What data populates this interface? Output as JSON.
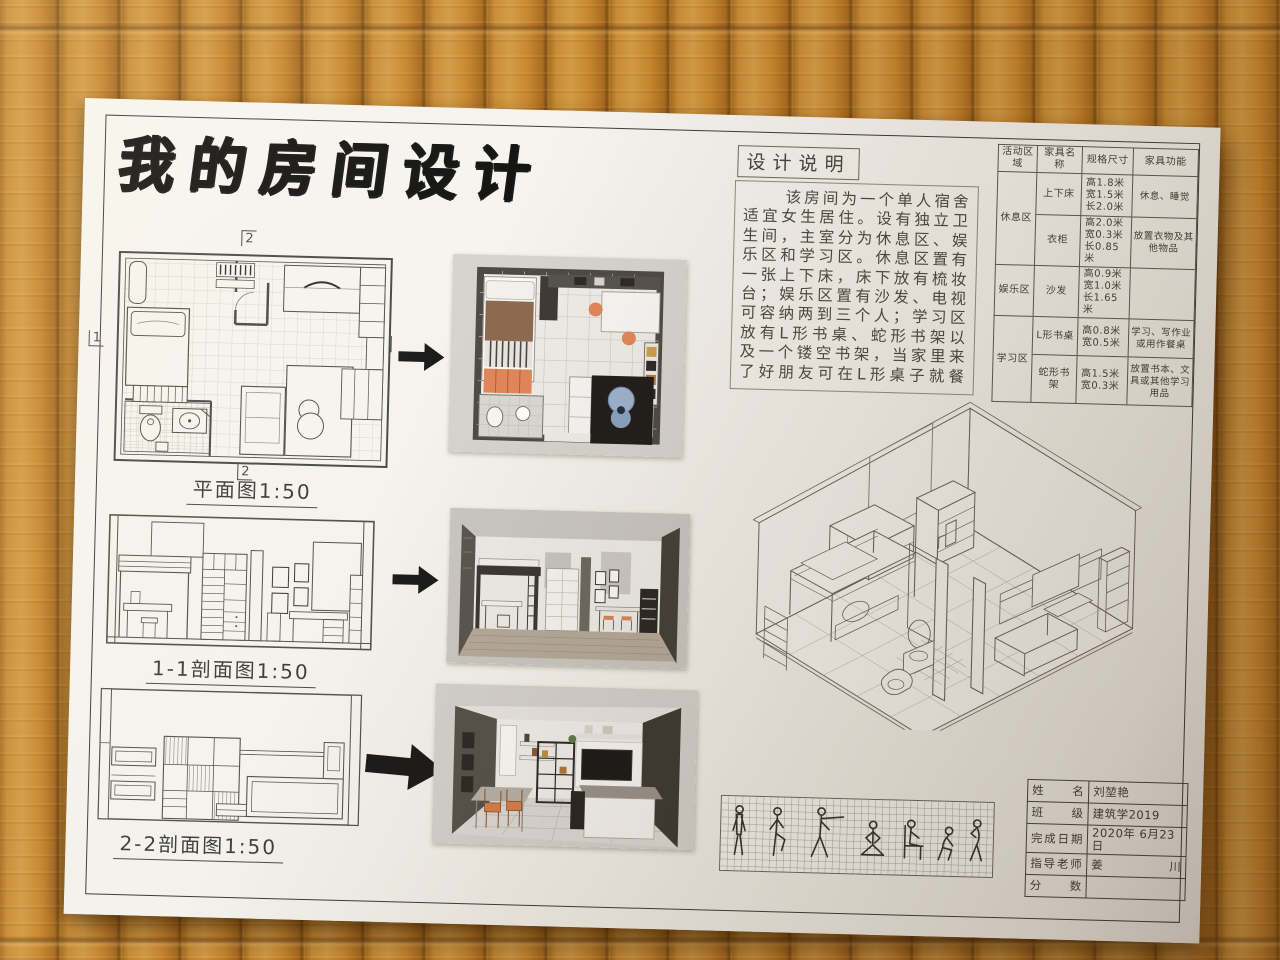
{
  "poster": {
    "title": "我的房间设计",
    "plan": {
      "label": "平面图1:50",
      "marker_top": "2",
      "marker_bottom": "2",
      "marker_left": "1",
      "marker_right": "1"
    },
    "section1": {
      "label": "1-1剖面图1:50"
    },
    "section2": {
      "label": "2-2剖面图1:50"
    },
    "design_notes": {
      "heading": "设计说明",
      "lines": [
        "该房间为一个单人宿舍",
        "适宜女生居住。设有独立卫",
        "生间，主室分为休息区、娱",
        "乐区和学习区。休息区置有",
        "一张上下床，床下放有梳妆",
        "台；娱乐区置有沙发、电视",
        "可容纳两到三个人；学习区",
        "放有L形书桌、蛇形书架以",
        "及一个镂空书架，当家里来",
        "了好朋友可在L形桌子就餐"
      ]
    },
    "furniture_table": {
      "headers": [
        "活动区域",
        "家具名称",
        "规格尺寸",
        "家具功能"
      ],
      "rows": [
        {
          "zone": "休息区",
          "name": "上下床",
          "size": "高1.8米\n宽1.5米\n长2.0米",
          "function": "休息、睡觉"
        },
        {
          "zone": "休息区",
          "name": "衣柜",
          "size": "高2.0米\n宽0.3米\n长0.85米",
          "function": "放置衣物及其他物品"
        },
        {
          "zone": "娱乐区",
          "name": "沙发",
          "size": "高0.9米\n宽1.0米\n长1.65米",
          "function": ""
        },
        {
          "zone": "学习区",
          "name": "L形书桌",
          "size": "高0.8米\n宽0.5米",
          "function": "学习、写作业或用作餐桌"
        },
        {
          "zone": "学习区",
          "name": "蛇形书架",
          "size": "高1.5米\n宽0.3米",
          "function": "放置书本、文具或其他学习用品"
        }
      ]
    },
    "info_table": {
      "rows": [
        {
          "label": "姓 名",
          "value": "刘堃艳"
        },
        {
          "label": "班 级",
          "value": "建筑学2019"
        },
        {
          "label": "完成日期",
          "value": "2020年 6月23日"
        },
        {
          "label": "指导老师",
          "value": "姜 川"
        },
        {
          "label": "分 数",
          "value": ""
        }
      ]
    },
    "icons": {
      "arrow": "arrow-right"
    },
    "colors": {
      "paper": "#f4f2ed",
      "ink": "#3a3a3a",
      "bamboo": "#c4862f",
      "accent_orange": "#e2875a",
      "accent_blue": "#9db3cd",
      "wall_dark": "#4e4a46"
    }
  }
}
